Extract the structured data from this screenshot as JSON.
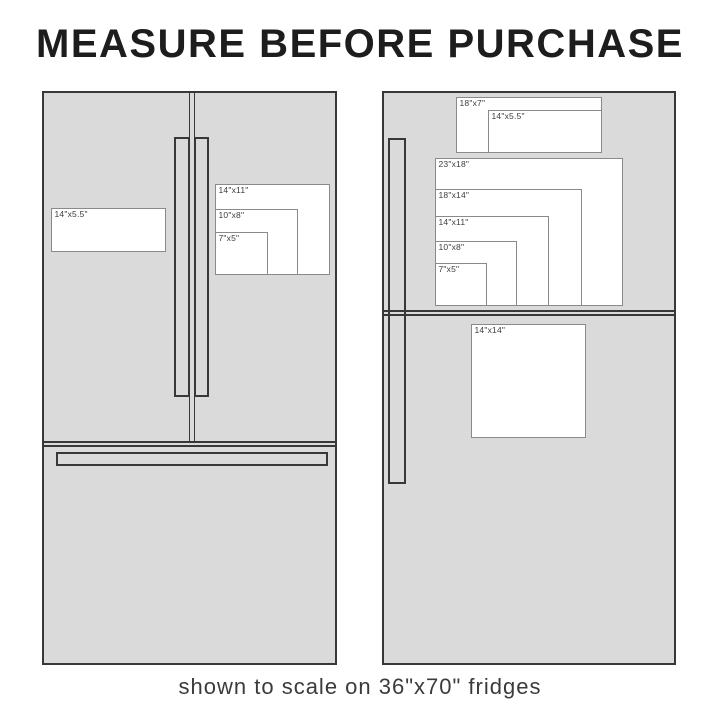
{
  "title": "MEASURE BEFORE PURCHASE",
  "caption": "shown to scale on 36\"x70\" fridges",
  "colors": {
    "background": "#ffffff",
    "fridge_fill": "#dadada",
    "fridge_outline": "#383838",
    "magnet_fill": "#ffffff",
    "magnet_border": "#8a8a8a",
    "title_text": "#1d1d1d",
    "caption_text": "#3b3b3b",
    "label_text": "#3d3d3d"
  },
  "left_fridge": {
    "style": "french-door-fridge",
    "magnets": [
      {
        "label": "14\"x5.5\""
      },
      {
        "label": "14\"x11\""
      },
      {
        "label": "10\"x8\""
      },
      {
        "label": "7\"x5\""
      }
    ]
  },
  "right_fridge": {
    "style": "top-freezer-fridge",
    "magnets": [
      {
        "label": "18\"x7\""
      },
      {
        "label": "14\"x5.5\""
      },
      {
        "label": "23\"x18\""
      },
      {
        "label": "18\"x14\""
      },
      {
        "label": "14\"x11\""
      },
      {
        "label": "10\"x8\""
      },
      {
        "label": "7\"x5\""
      },
      {
        "label": "14\"x14\""
      }
    ]
  }
}
